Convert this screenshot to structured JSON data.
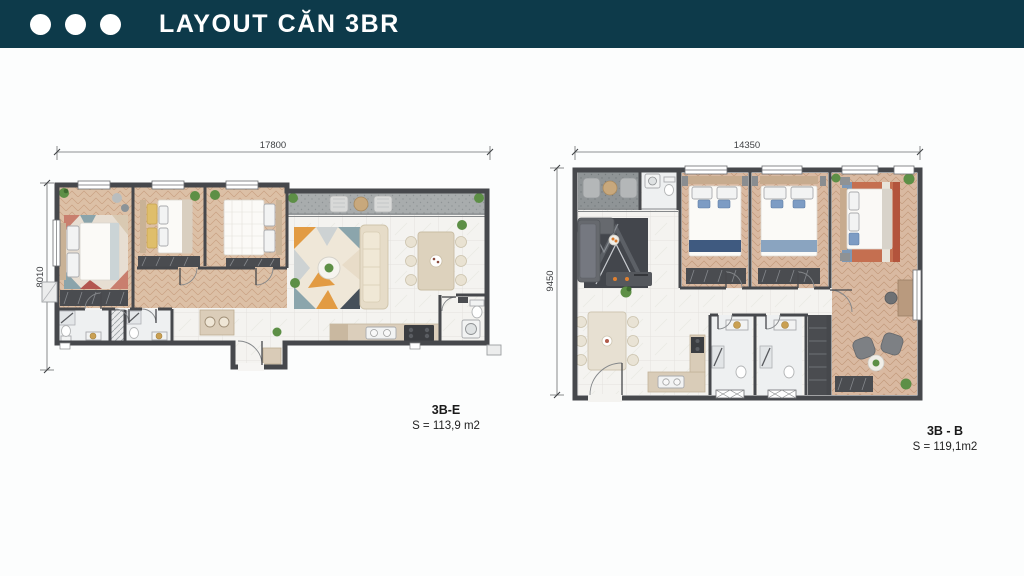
{
  "header": {
    "title": "LAYOUT CĂN 3BR",
    "dots": [
      "dot",
      "dot",
      "dot"
    ]
  },
  "plans": [
    {
      "name": "3B-E",
      "area": "S = 113,9 m2",
      "dim_width": "17800",
      "dim_height": "8010"
    },
    {
      "name": "3B - B",
      "area": "S = 119,1m2",
      "dim_width": "14350",
      "dim_height": "9450"
    }
  ],
  "palette": {
    "page-bg": "#fcfdfd",
    "header-bg": "#0d3a4a",
    "dot-color": "#ffffff",
    "wall": "#46484c",
    "wood": "#dcc0a6",
    "wood2": "#d9b9a1",
    "marble": "#f4f3f0",
    "terrace": "#a8acad",
    "balcony": "#8f9496",
    "rug-orange": "#e29b43",
    "rug-teal": "#8aa4ab",
    "sofa-beige": "#e6dcc8",
    "sofa-dark": "#66696e",
    "navy": "#3f5a80",
    "plant-green": "#5d8f46"
  }
}
